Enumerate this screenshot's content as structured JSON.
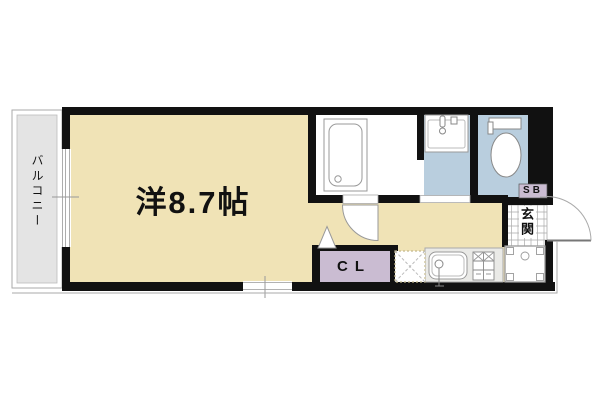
{
  "floor_plan": {
    "labels": {
      "main_room": "洋8.7帖",
      "balcony": "バルコニー",
      "closet": "CL",
      "shoe_box": "SB",
      "entrance": "玄関"
    },
    "colors": {
      "room_floor": "#f0e3b6",
      "wet_area_floor": "#b9cede",
      "closet_fill": "#cabcd2",
      "shoe_box_fill": "#cabcd2",
      "balcony_fill": "#e4e4e4",
      "kitchen_counter": "#eaeae7",
      "wall": "#111111",
      "fixture_outline": "#999999"
    },
    "fixtures": [
      {
        "name": "bathtub"
      },
      {
        "name": "wash-basin"
      },
      {
        "name": "toilet"
      },
      {
        "name": "kitchen-sink"
      },
      {
        "name": "gas-stove"
      },
      {
        "name": "refrigerator-space"
      },
      {
        "name": "washing-machine-space"
      },
      {
        "name": "entrance-door"
      },
      {
        "name": "room-door"
      },
      {
        "name": "closet"
      },
      {
        "name": "shoe-box"
      }
    ]
  }
}
